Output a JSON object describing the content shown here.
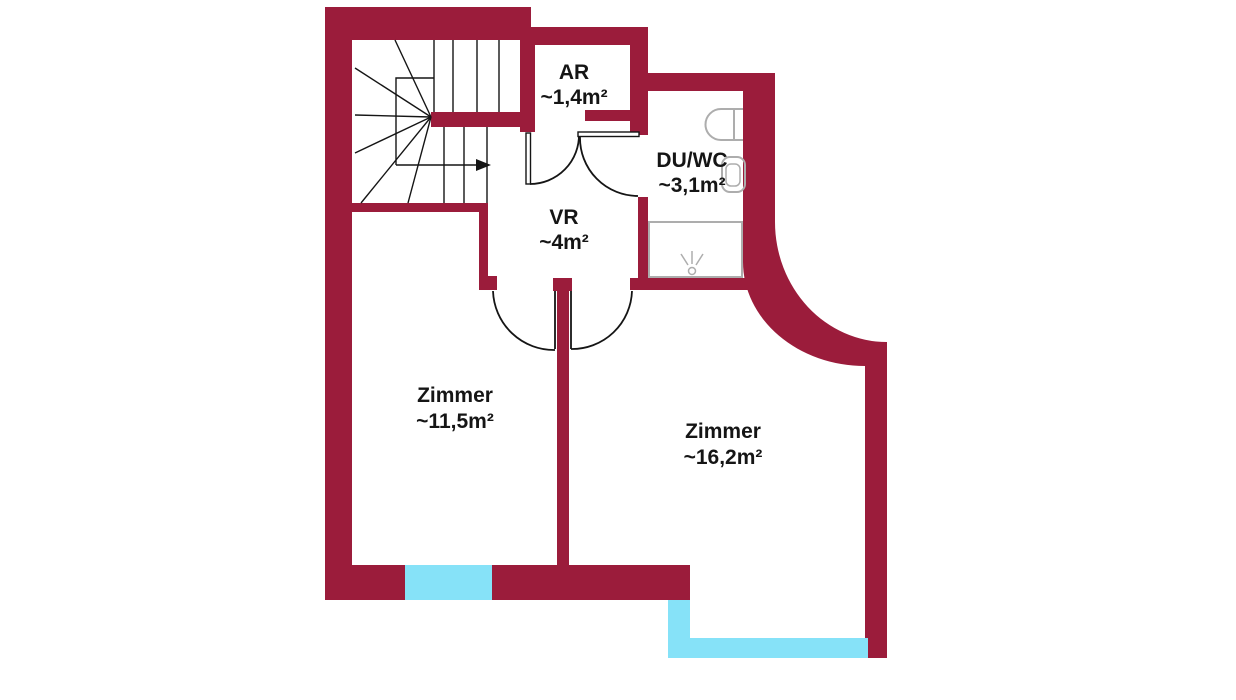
{
  "colors": {
    "wall_color": "#9B1C3B",
    "window_color": "#86E2F8",
    "line_color": "#151515",
    "fixture_color": "#ADADAD",
    "text_color": "#151515",
    "background": "#FFFFFF"
  },
  "rooms": {
    "storage": {
      "name": "AR",
      "area": "~1,4m²"
    },
    "bathroom": {
      "name": "DU/WC",
      "area": "~3,1m²"
    },
    "vestibule": {
      "name": "VR",
      "area": "~4m²"
    },
    "room_left": {
      "name": "Zimmer",
      "area": "~11,5m²"
    },
    "room_right": {
      "name": "Zimmer",
      "area": "~16,2m²"
    }
  }
}
